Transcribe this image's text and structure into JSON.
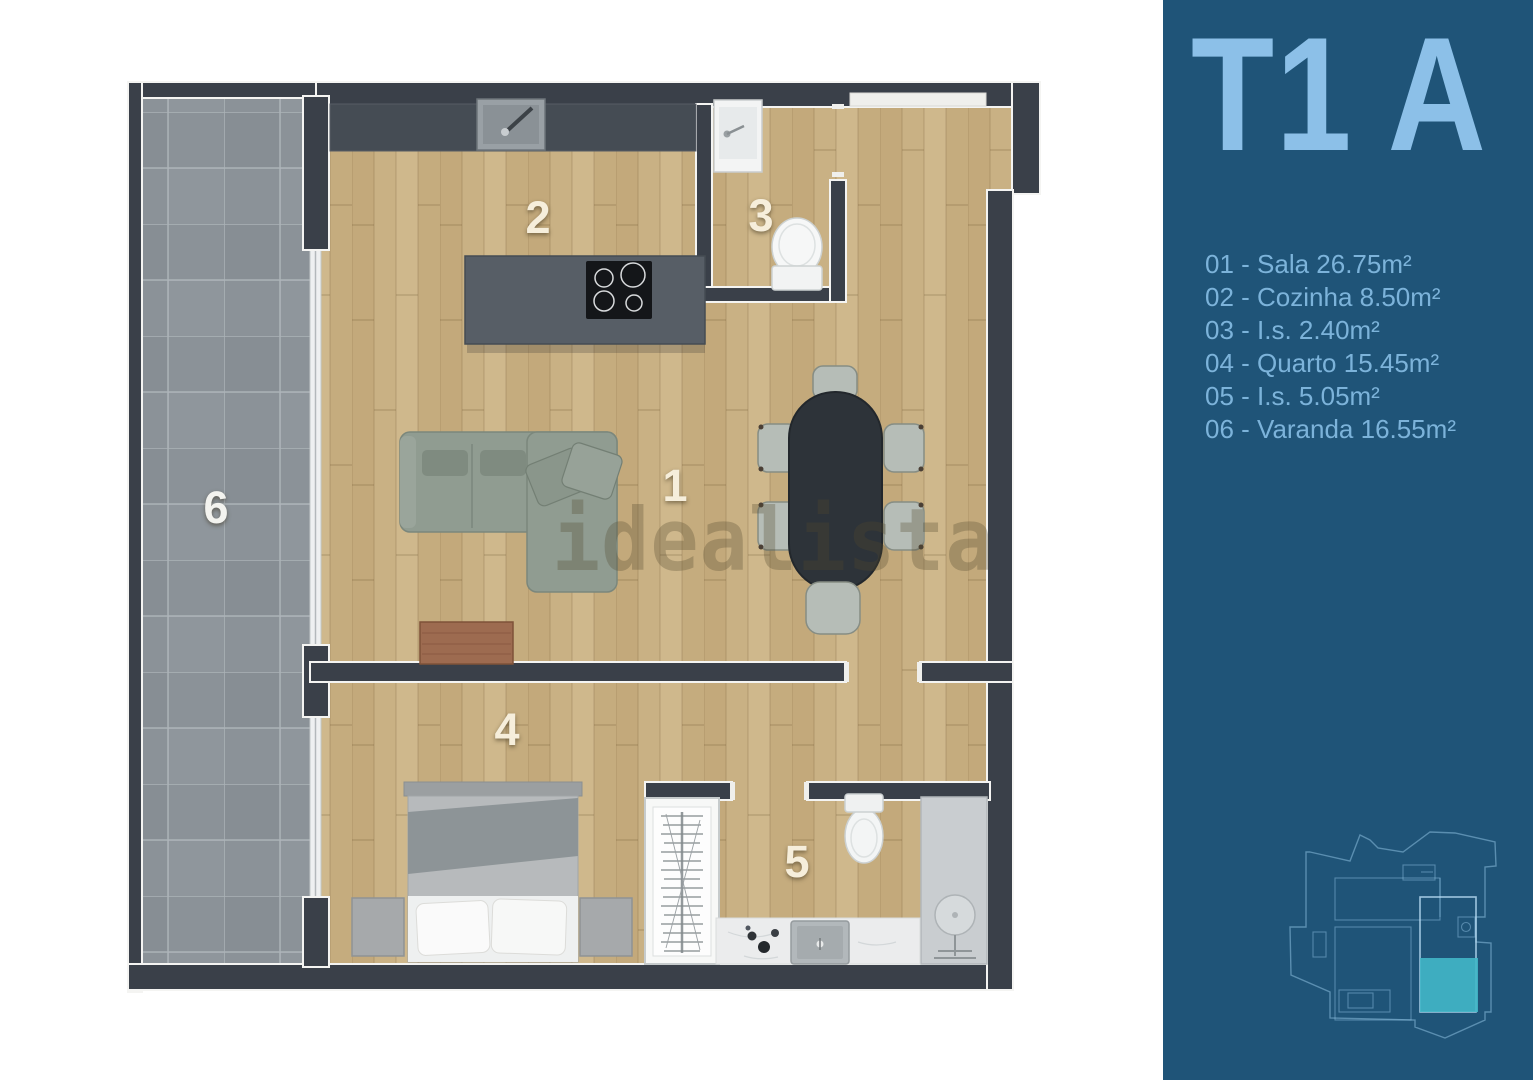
{
  "floor_plan": {
    "watermark": "idealista",
    "room_labels": [
      {
        "number": "1",
        "room": "Sala"
      },
      {
        "number": "2",
        "room": "Cozinha"
      },
      {
        "number": "3",
        "room": "I.s."
      },
      {
        "number": "4",
        "room": "Quarto"
      },
      {
        "number": "5",
        "room": "I.s."
      },
      {
        "number": "6",
        "room": "Varanda"
      }
    ],
    "colors": {
      "walls": "#3a4049",
      "wood_floor": "#c9b184",
      "balcony_tile": "#8b9298"
    }
  },
  "sidebar": {
    "title": "T1 A",
    "legend": [
      {
        "text": "01 - Sala 26.75m²"
      },
      {
        "text": "02 - Cozinha 8.50m²"
      },
      {
        "text": "03 - I.s. 2.40m²"
      },
      {
        "text": "04 - Quarto 15.45m²"
      },
      {
        "text": "05 - I.s. 5.05m²"
      },
      {
        "text": "06 - Varanda 16.55m²"
      }
    ],
    "colors": {
      "background": "#1f5478",
      "title": "#8cc0e8",
      "legend_text": "#7cb3da",
      "unit_highlight": "#41b7c8",
      "outline": "#9ccbe8"
    }
  }
}
